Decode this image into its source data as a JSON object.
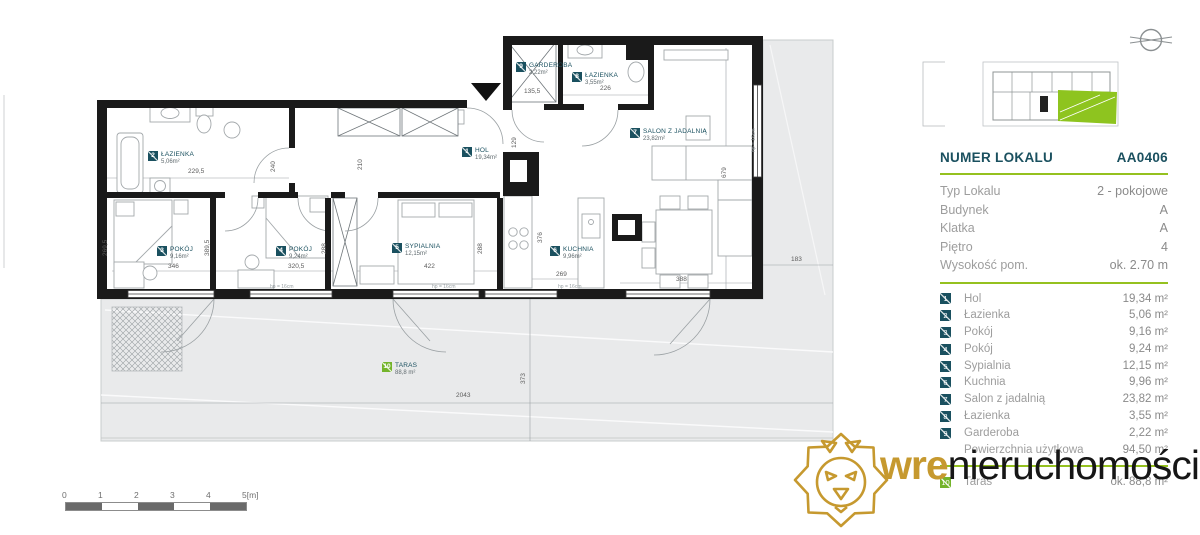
{
  "sidebar": {
    "header": {
      "label": "NUMER LOKALU",
      "value": "AA0406"
    },
    "info": [
      {
        "label": "Typ Lokalu",
        "value": "2 - pokojowe"
      },
      {
        "label": "Budynek",
        "value": "A"
      },
      {
        "label": "Klatka",
        "value": "A"
      },
      {
        "label": "Piętro",
        "value": "4"
      },
      {
        "label": "Wysokość pom.",
        "value": "ok. 2.70 m"
      }
    ],
    "rooms": [
      {
        "num": "1",
        "name": "Hol",
        "area": "19,34 m²"
      },
      {
        "num": "2",
        "name": "Łazienka",
        "area": "5,06 m²"
      },
      {
        "num": "3",
        "name": "Pokój",
        "area": "9,16 m²"
      },
      {
        "num": "4",
        "name": "Pokój",
        "area": "9,24 m²"
      },
      {
        "num": "5",
        "name": "Sypialnia",
        "area": "12,15 m²"
      },
      {
        "num": "6",
        "name": "Kuchnia",
        "area": "9,96 m²"
      },
      {
        "num": "7",
        "name": "Salon z jadalnią",
        "area": "23,82 m²"
      },
      {
        "num": "8",
        "name": "Łazienka",
        "area": "3,55 m²"
      },
      {
        "num": "9",
        "name": "Garderoba",
        "area": "2,22 m²"
      }
    ],
    "total": {
      "label": "Powierzchnia użytkowa",
      "value": "94,50 m²"
    },
    "terrace": {
      "num": "10",
      "name": "Taras",
      "area": "ok. 88,8 m²"
    }
  },
  "plan": {
    "room_labels": [
      {
        "num": "1",
        "name": "HOL",
        "area": "19,34m²",
        "x": 462,
        "y": 147,
        "green": false
      },
      {
        "num": "2",
        "name": "ŁAZIENKA",
        "area": "5,06m²",
        "x": 148,
        "y": 151,
        "green": false
      },
      {
        "num": "3",
        "name": "POKÓJ",
        "area": "9,16m²",
        "x": 157,
        "y": 246,
        "green": false
      },
      {
        "num": "4",
        "name": "POKÓJ",
        "area": "9,24m²",
        "x": 276,
        "y": 246,
        "green": false
      },
      {
        "num": "5",
        "name": "SYPIALNIA",
        "area": "12,15m²",
        "x": 392,
        "y": 243,
        "green": false
      },
      {
        "num": "6",
        "name": "KUCHNIA",
        "area": "9,96m²",
        "x": 550,
        "y": 246,
        "green": false
      },
      {
        "num": "7",
        "name": "SALON Z JADALNIĄ",
        "area": "23,82m²",
        "x": 630,
        "y": 128,
        "green": false
      },
      {
        "num": "8",
        "name": "ŁAZIENKA",
        "area": "3,55m²",
        "x": 572,
        "y": 72,
        "green": false
      },
      {
        "num": "9",
        "name": "GARDEROBA",
        "area": "2,22m²",
        "x": 516,
        "y": 62,
        "green": false
      },
      {
        "num": "10",
        "name": "TARAS",
        "area": "88,8 m²",
        "x": 382,
        "y": 362,
        "green": true
      }
    ],
    "dimensions": [
      {
        "t": "229,5",
        "x": 188,
        "y": 168,
        "v": false
      },
      {
        "t": "240",
        "x": 270,
        "y": 172,
        "v": true
      },
      {
        "t": "269,5",
        "x": 102,
        "y": 256,
        "v": true
      },
      {
        "t": "346",
        "x": 168,
        "y": 263,
        "v": false
      },
      {
        "t": "389,5",
        "x": 204,
        "y": 256,
        "v": true
      },
      {
        "t": "320,5",
        "x": 288,
        "y": 263,
        "v": false
      },
      {
        "t": "288",
        "x": 321,
        "y": 254,
        "v": true
      },
      {
        "t": "210",
        "x": 357,
        "y": 170,
        "v": true
      },
      {
        "t": "422",
        "x": 424,
        "y": 263,
        "v": false
      },
      {
        "t": "288",
        "x": 477,
        "y": 254,
        "v": true
      },
      {
        "t": "376",
        "x": 537,
        "y": 243,
        "v": true
      },
      {
        "t": "269",
        "x": 556,
        "y": 271,
        "v": false
      },
      {
        "t": "388",
        "x": 676,
        "y": 276,
        "v": false
      },
      {
        "t": "129",
        "x": 511,
        "y": 148,
        "v": true
      },
      {
        "t": "135,5",
        "x": 524,
        "y": 88,
        "v": false
      },
      {
        "t": "226",
        "x": 600,
        "y": 85,
        "v": false
      },
      {
        "t": "679",
        "x": 721,
        "y": 178,
        "v": true
      },
      {
        "t": "183",
        "x": 791,
        "y": 256,
        "v": false
      },
      {
        "t": "373",
        "x": 520,
        "y": 384,
        "v": true
      },
      {
        "t": "2043",
        "x": 456,
        "y": 392,
        "v": false
      }
    ],
    "notes": [
      {
        "t": "hp = 16cm",
        "x": 270,
        "y": 284,
        "v": false
      },
      {
        "t": "hp = 16cm",
        "x": 432,
        "y": 284,
        "v": false
      },
      {
        "t": "hp = 16cm",
        "x": 558,
        "y": 284,
        "v": false
      },
      {
        "t": "hp = 16cm",
        "x": 751,
        "y": 152,
        "v": true
      }
    ]
  },
  "scalebar": {
    "ticks": [
      "0",
      "1",
      "2",
      "3",
      "4",
      "5[m]"
    ]
  },
  "logo": {
    "bold": "wre",
    "rest": "nieruchomości"
  },
  "colors": {
    "accent_green": "#95c11f",
    "teal": "#1a505f",
    "gold": "#c6992f",
    "taras_green": "#74b42b"
  }
}
